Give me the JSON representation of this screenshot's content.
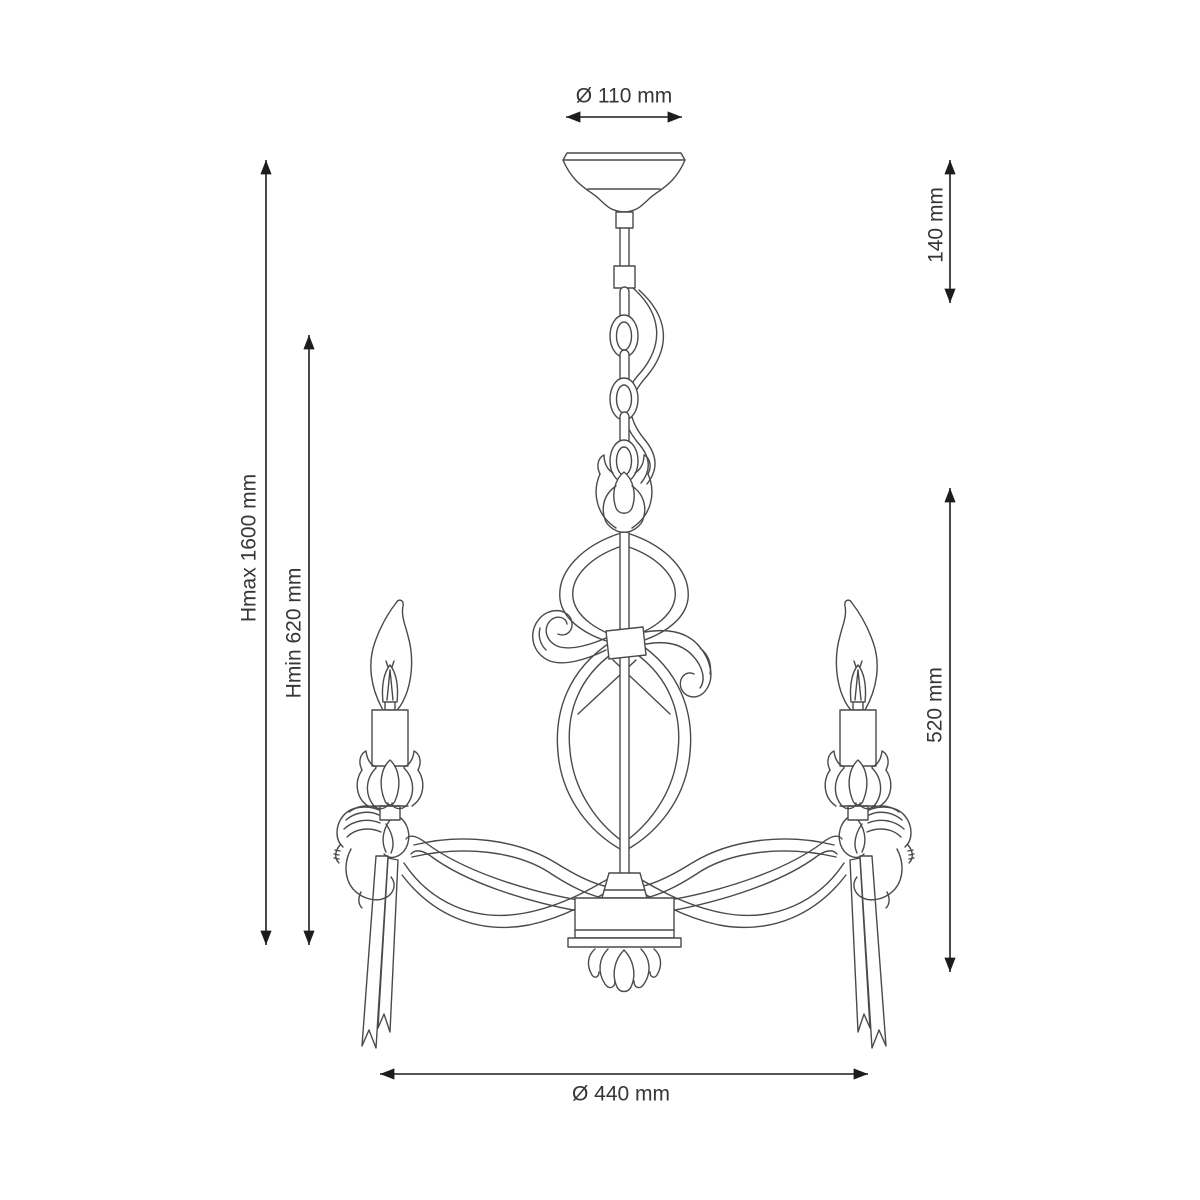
{
  "drawing": {
    "kind": "technical dimension drawing",
    "subject": "3-arm cherub candle chandelier",
    "background_color": "#ffffff",
    "line_color": "#4a4a4a",
    "dimension_line_color": "#1c1c1c",
    "label_color": "#363636"
  },
  "dimensions": {
    "canopy_diameter": "Ø 110 mm",
    "canopy_drop": "140 mm",
    "height_max": "Hmax 1600 mm",
    "height_min": "Hmin 620 mm",
    "fixture_height": "520 mm",
    "fixture_diameter": "Ø 440 mm"
  }
}
